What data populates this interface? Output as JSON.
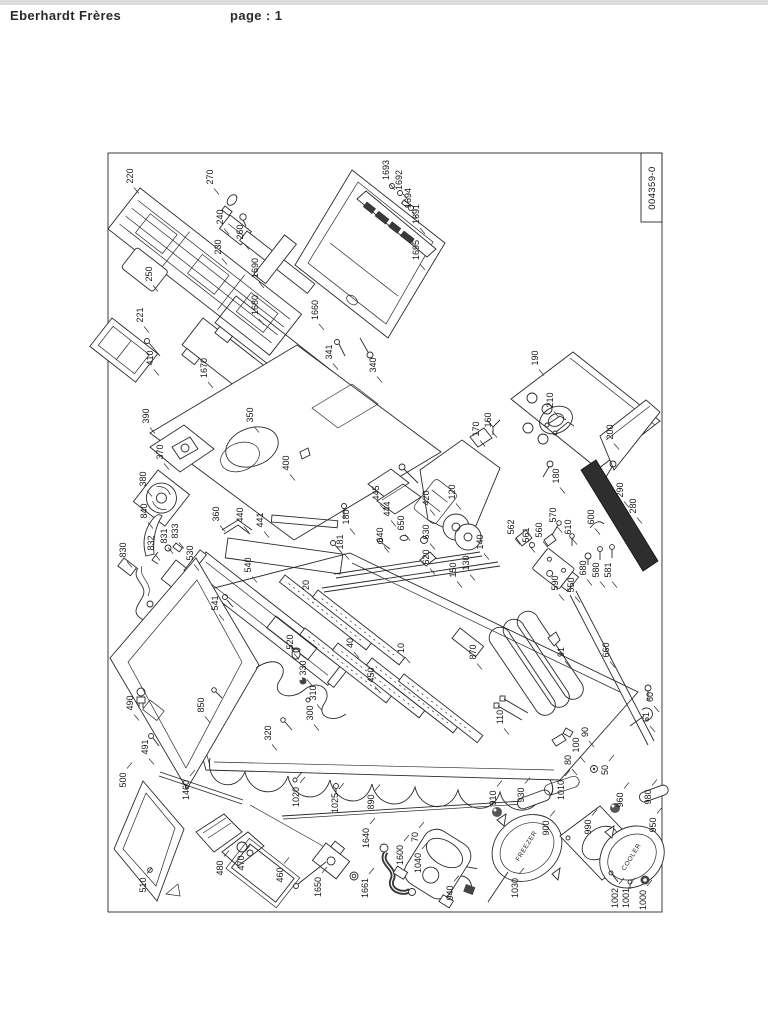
{
  "header": {
    "company": "Eberhardt Frères",
    "page_label": "page : 1"
  },
  "title_block": {
    "doc_number": "004359-0"
  },
  "diagram": {
    "part_labels": [
      {
        "t": "220",
        "x": 133,
        "y": 176
      },
      {
        "t": "270",
        "x": 213,
        "y": 177
      },
      {
        "t": "240",
        "x": 223,
        "y": 217
      },
      {
        "t": "260",
        "x": 243,
        "y": 232
      },
      {
        "t": "230",
        "x": 221,
        "y": 247
      },
      {
        "t": "250",
        "x": 152,
        "y": 274
      },
      {
        "t": "221",
        "x": 143,
        "y": 315
      },
      {
        "t": "410",
        "x": 153,
        "y": 358
      },
      {
        "t": "1690",
        "x": 258,
        "y": 268
      },
      {
        "t": "1680",
        "x": 258,
        "y": 305
      },
      {
        "t": "1660",
        "x": 318,
        "y": 310
      },
      {
        "t": "1693",
        "x": 389,
        "y": 170
      },
      {
        "t": "1692",
        "x": 402,
        "y": 180
      },
      {
        "t": "1694",
        "x": 411,
        "y": 198
      },
      {
        "t": "1691",
        "x": 419,
        "y": 214
      },
      {
        "t": "1695",
        "x": 419,
        "y": 250
      },
      {
        "t": "1670",
        "x": 207,
        "y": 368
      },
      {
        "t": "341",
        "x": 332,
        "y": 352
      },
      {
        "t": "340",
        "x": 376,
        "y": 365
      },
      {
        "t": "390",
        "x": 149,
        "y": 416
      },
      {
        "t": "350",
        "x": 253,
        "y": 415
      },
      {
        "t": "370",
        "x": 163,
        "y": 452
      },
      {
        "t": "380",
        "x": 146,
        "y": 479
      },
      {
        "t": "840",
        "x": 147,
        "y": 511
      },
      {
        "t": "400",
        "x": 289,
        "y": 463
      },
      {
        "t": "190",
        "x": 538,
        "y": 358
      },
      {
        "t": "210",
        "x": 553,
        "y": 400
      },
      {
        "t": "160",
        "x": 491,
        "y": 420
      },
      {
        "t": "170",
        "x": 479,
        "y": 429
      },
      {
        "t": "200",
        "x": 613,
        "y": 432
      },
      {
        "t": "180",
        "x": 559,
        "y": 476
      },
      {
        "t": "290",
        "x": 623,
        "y": 490
      },
      {
        "t": "280",
        "x": 636,
        "y": 506
      },
      {
        "t": "120",
        "x": 455,
        "y": 492
      },
      {
        "t": "600",
        "x": 594,
        "y": 517
      },
      {
        "t": "570",
        "x": 556,
        "y": 515
      },
      {
        "t": "610",
        "x": 571,
        "y": 527
      },
      {
        "t": "560",
        "x": 542,
        "y": 530
      },
      {
        "t": "561",
        "x": 529,
        "y": 535
      },
      {
        "t": "562",
        "x": 514,
        "y": 527
      },
      {
        "t": "140",
        "x": 483,
        "y": 542
      },
      {
        "t": "130",
        "x": 469,
        "y": 563
      },
      {
        "t": "150",
        "x": 456,
        "y": 570
      },
      {
        "t": "680",
        "x": 586,
        "y": 568
      },
      {
        "t": "580",
        "x": 599,
        "y": 570
      },
      {
        "t": "581",
        "x": 611,
        "y": 570
      },
      {
        "t": "590",
        "x": 558,
        "y": 583
      },
      {
        "t": "550",
        "x": 574,
        "y": 585
      },
      {
        "t": "830",
        "x": 126,
        "y": 550
      },
      {
        "t": "832",
        "x": 154,
        "y": 543
      },
      {
        "t": "831",
        "x": 167,
        "y": 536
      },
      {
        "t": "833",
        "x": 178,
        "y": 531
      },
      {
        "t": "530",
        "x": 193,
        "y": 553
      },
      {
        "t": "540",
        "x": 251,
        "y": 565
      },
      {
        "t": "541",
        "x": 218,
        "y": 603
      },
      {
        "t": "360",
        "x": 219,
        "y": 514
      },
      {
        "t": "440",
        "x": 243,
        "y": 515
      },
      {
        "t": "441",
        "x": 263,
        "y": 520
      },
      {
        "t": "180",
        "x": 349,
        "y": 517
      },
      {
        "t": "181",
        "x": 343,
        "y": 542
      },
      {
        "t": "445",
        "x": 379,
        "y": 493
      },
      {
        "t": "444",
        "x": 390,
        "y": 509
      },
      {
        "t": "420",
        "x": 429,
        "y": 498
      },
      {
        "t": "650",
        "x": 404,
        "y": 523
      },
      {
        "t": "640",
        "x": 383,
        "y": 535
      },
      {
        "t": "630",
        "x": 429,
        "y": 532
      },
      {
        "t": "620",
        "x": 429,
        "y": 557
      },
      {
        "t": "20",
        "x": 309,
        "y": 585
      },
      {
        "t": "40",
        "x": 353,
        "y": 643
      },
      {
        "t": "10",
        "x": 404,
        "y": 648
      },
      {
        "t": "450",
        "x": 374,
        "y": 675
      },
      {
        "t": "520",
        "x": 293,
        "y": 642
      },
      {
        "t": "330",
        "x": 306,
        "y": 668
      },
      {
        "t": "310",
        "x": 316,
        "y": 693
      },
      {
        "t": "300",
        "x": 313,
        "y": 713
      },
      {
        "t": "320",
        "x": 271,
        "y": 733
      },
      {
        "t": "850",
        "x": 204,
        "y": 705
      },
      {
        "t": "490",
        "x": 133,
        "y": 703
      },
      {
        "t": "491",
        "x": 148,
        "y": 747
      },
      {
        "t": "500",
        "x": 126,
        "y": 780
      },
      {
        "t": "510",
        "x": 146,
        "y": 885
      },
      {
        "t": "1460",
        "x": 189,
        "y": 790
      },
      {
        "t": "870",
        "x": 476,
        "y": 652
      },
      {
        "t": "91",
        "x": 564,
        "y": 652
      },
      {
        "t": "660",
        "x": 609,
        "y": 650
      },
      {
        "t": "60",
        "x": 653,
        "y": 697
      },
      {
        "t": "61",
        "x": 649,
        "y": 717
      },
      {
        "t": "110",
        "x": 503,
        "y": 717
      },
      {
        "t": "90",
        "x": 588,
        "y": 732
      },
      {
        "t": "100",
        "x": 579,
        "y": 745
      },
      {
        "t": "80",
        "x": 571,
        "y": 760
      },
      {
        "t": "50",
        "x": 608,
        "y": 770
      },
      {
        "t": "1020",
        "x": 299,
        "y": 797
      },
      {
        "t": "1025",
        "x": 338,
        "y": 803
      },
      {
        "t": "890",
        "x": 374,
        "y": 802
      },
      {
        "t": "1640",
        "x": 369,
        "y": 838
      },
      {
        "t": "70",
        "x": 418,
        "y": 837
      },
      {
        "t": "1600",
        "x": 403,
        "y": 855
      },
      {
        "t": "1040",
        "x": 421,
        "y": 863
      },
      {
        "t": "460",
        "x": 283,
        "y": 875
      },
      {
        "t": "1650",
        "x": 321,
        "y": 887
      },
      {
        "t": "1661",
        "x": 368,
        "y": 888
      },
      {
        "t": "940",
        "x": 453,
        "y": 893
      },
      {
        "t": "470",
        "x": 244,
        "y": 863
      },
      {
        "t": "480",
        "x": 223,
        "y": 868
      },
      {
        "t": "910",
        "x": 496,
        "y": 798
      },
      {
        "t": "930",
        "x": 524,
        "y": 795
      },
      {
        "t": "1010",
        "x": 564,
        "y": 790
      },
      {
        "t": "960",
        "x": 623,
        "y": 800
      },
      {
        "t": "980",
        "x": 651,
        "y": 797
      },
      {
        "t": "900",
        "x": 549,
        "y": 828
      },
      {
        "t": "990",
        "x": 591,
        "y": 827
      },
      {
        "t": "950",
        "x": 656,
        "y": 825
      },
      {
        "t": "1030",
        "x": 518,
        "y": 888
      },
      {
        "t": "1002",
        "x": 618,
        "y": 898
      },
      {
        "t": "1001",
        "x": 629,
        "y": 898
      },
      {
        "t": "1000",
        "x": 646,
        "y": 900
      }
    ],
    "component_texts": [
      {
        "t": "FREEZER",
        "x": 528,
        "y": 847,
        "r": -58
      },
      {
        "t": "COOLER",
        "x": 633,
        "y": 858,
        "r": -58
      }
    ]
  }
}
